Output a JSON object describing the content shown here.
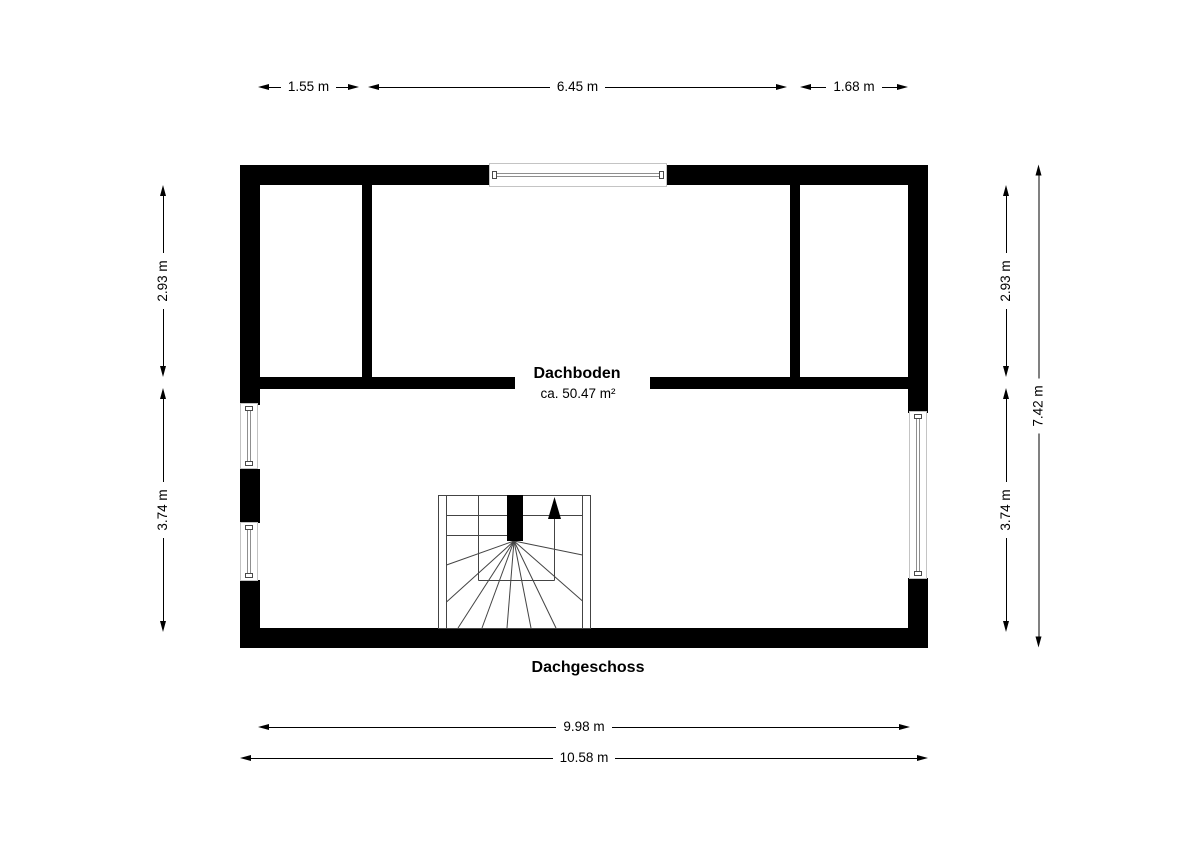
{
  "floorplan": {
    "floor_label": "Dachgeschoss",
    "room": {
      "name": "Dachboden",
      "area": "ca. 50.47 m²"
    },
    "stairs": {
      "type": "winder-staircase",
      "direction": "up"
    },
    "dimensions": {
      "top": [
        "1.55 m",
        "6.45 m",
        "1.68 m"
      ],
      "left": [
        "2.93 m",
        "3.74 m"
      ],
      "right_inner": [
        "2.93 m",
        "3.74 m"
      ],
      "right_outer": "7.42 m",
      "bottom_inner": "9.98 m",
      "bottom_outer": "10.58 m"
    },
    "colors": {
      "wall": "#000000",
      "background": "#ffffff",
      "dimension_line": "#000000",
      "window_frame_border": "#c4c4c4",
      "window_glass_line": "#8f8f8f",
      "stair_line": "#444444"
    }
  }
}
